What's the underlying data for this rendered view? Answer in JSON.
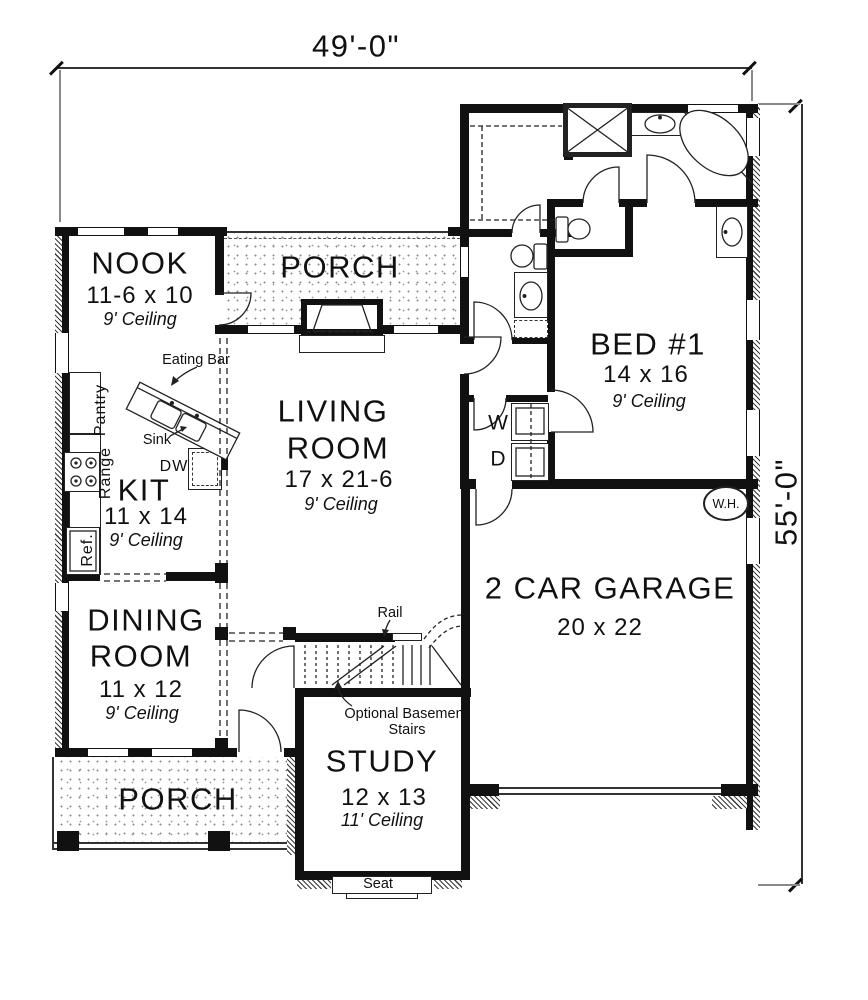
{
  "dimensions": {
    "width": "49'-0\"",
    "height": "55'-0\""
  },
  "rooms": {
    "nook": {
      "name": "NOOK",
      "size": "11-6 x 10",
      "ceiling": "9' Ceiling"
    },
    "porch_top": {
      "name": "PORCH"
    },
    "bed1": {
      "name": "BED #1",
      "size": "14 x 16",
      "ceiling": "9' Ceiling"
    },
    "living": {
      "name_line1": "LIVING",
      "name_line2": "ROOM",
      "size": "17 x 21-6",
      "ceiling": "9' Ceiling"
    },
    "kitchen": {
      "name": "KIT",
      "size": "11 x 14",
      "ceiling": "9' Ceiling"
    },
    "dining": {
      "name_line1": "DINING",
      "name_line2": "ROOM",
      "size": "11 x 12",
      "ceiling": "9' Ceiling"
    },
    "garage": {
      "name": "2 CAR GARAGE",
      "size": "20 x 22"
    },
    "study": {
      "name": "STUDY",
      "size": "12 x 13",
      "ceiling": "11' Ceiling"
    },
    "porch_bottom": {
      "name": "PORCH"
    }
  },
  "labels": {
    "eating_bar": "Eating Bar",
    "pantry": "Pantry",
    "sink": "Sink",
    "range": "Range",
    "ref": "Ref.",
    "dw": "DW",
    "washer": "W",
    "dryer": "D",
    "water_heater": "W.H.",
    "rail": "Rail",
    "stairs_note_line1": "Optional Basemen",
    "stairs_note_line2": "Stairs",
    "seat": "Seat"
  }
}
